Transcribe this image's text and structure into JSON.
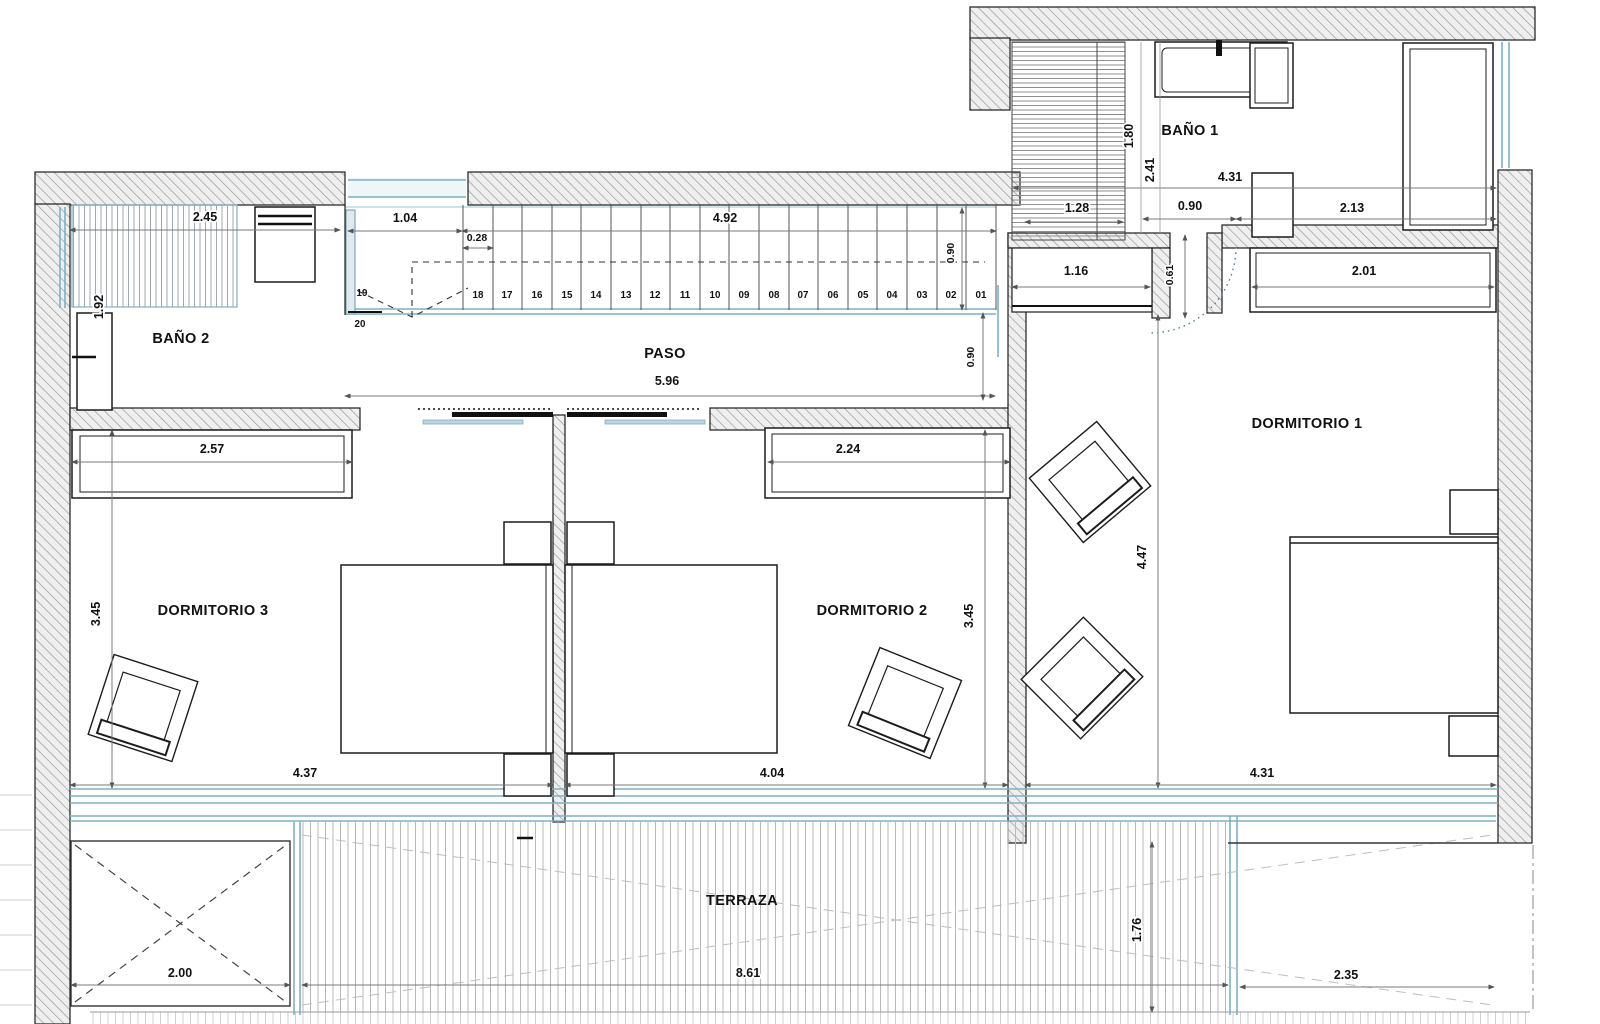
{
  "plan": {
    "title": "Planta - vivienda (floor plan)",
    "rooms": {
      "bano1": "BAÑO 1",
      "bano2": "BAÑO 2",
      "paso": "PASO",
      "dormitorio1": "DORMITORIO 1",
      "dormitorio2": "DORMITORIO 2",
      "dormitorio3": "DORMITORIO 3",
      "terraza": "TERRAZA"
    },
    "dimensions": {
      "bano2_width": "2.45",
      "bano2_depth": "1.92",
      "stair_landing": "1.04",
      "stair_tread": "0.28",
      "stair_run": "4.92",
      "stair_width": "0.90",
      "paso_length": "5.96",
      "paso_width": "0.90",
      "bano1_dim_a": "1.80",
      "bano1_dim_b": "2.41",
      "bano1_width": "4.31",
      "bano1_closet": "1.28",
      "bano1_door": "0.90",
      "bano1_right": "2.13",
      "dorm1_closet": "1.16",
      "dorm1_door": "0.61",
      "dorm1_wardrobe": "2.01",
      "dorm3_wardrobe": "2.57",
      "dorm2_wardrobe": "2.24",
      "dorm3_depth": "3.45",
      "dorm2_depth": "3.45",
      "dorm1_depth": "4.47",
      "dorm3_width": "4.37",
      "dorm2_width": "4.04",
      "dorm1_width": "4.31",
      "skylight_width": "2.00",
      "terraza_width": "8.61",
      "terraza_depth": "1.76",
      "terraza_open_width": "2.35"
    },
    "stairs": {
      "steps": [
        "01",
        "02",
        "03",
        "04",
        "05",
        "06",
        "07",
        "08",
        "09",
        "10",
        "11",
        "12",
        "13",
        "14",
        "15",
        "16",
        "17",
        "18"
      ],
      "step19": "19",
      "step20": "20"
    },
    "colors": {
      "wall_hatch": "#9b9b9b",
      "glazing_teal": "#7fb0c2",
      "dim_line": "#787878",
      "deck_line": "#b8b8b8",
      "ink": "#111111"
    }
  }
}
